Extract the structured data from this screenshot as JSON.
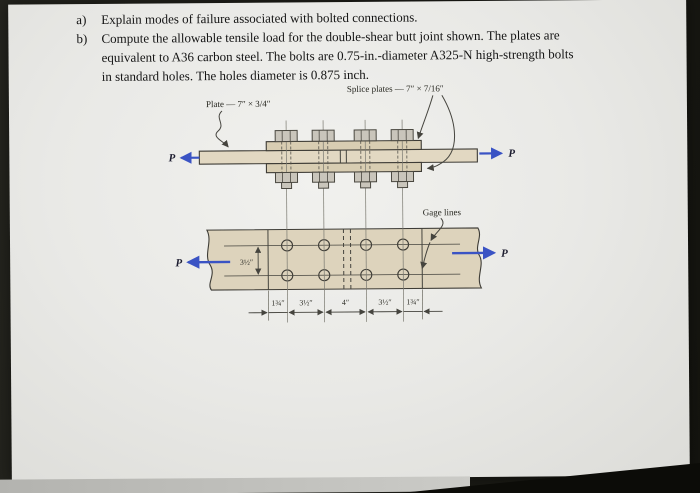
{
  "problem": {
    "items": [
      {
        "marker": "a)",
        "lines": [
          "Explain modes of failure associated with bolted connections."
        ]
      },
      {
        "marker": "b)",
        "lines": [
          "Compute the allowable tensile load for the double-shear butt joint shown. The plates are",
          "equivalent to A36 carbon steel. The bolts are 0.75-in.-diameter A325-N high-strength bolts",
          "in standard holes. The holes diameter is 0.875 inch."
        ]
      }
    ]
  },
  "figure": {
    "labels": {
      "splice_plates": "Splice plates — 7″ × 7/16″",
      "plate": "Plate — 7″ × 3/4″",
      "gage_lines": "Gage lines",
      "load": "P"
    },
    "dimensions": {
      "gage_spacing": "3½″",
      "bottom_chain": [
        "1¾″",
        "3½″",
        "4″",
        "3½″",
        "1¾″"
      ]
    },
    "colors": {
      "plate_fill": "#ddd3bc",
      "main_plate_fill": "#e2d8c2",
      "splice_fill": "#d8cdb2",
      "bolt_fill": "#c9c5bb",
      "arrow_blue": "#3a53c4"
    }
  }
}
